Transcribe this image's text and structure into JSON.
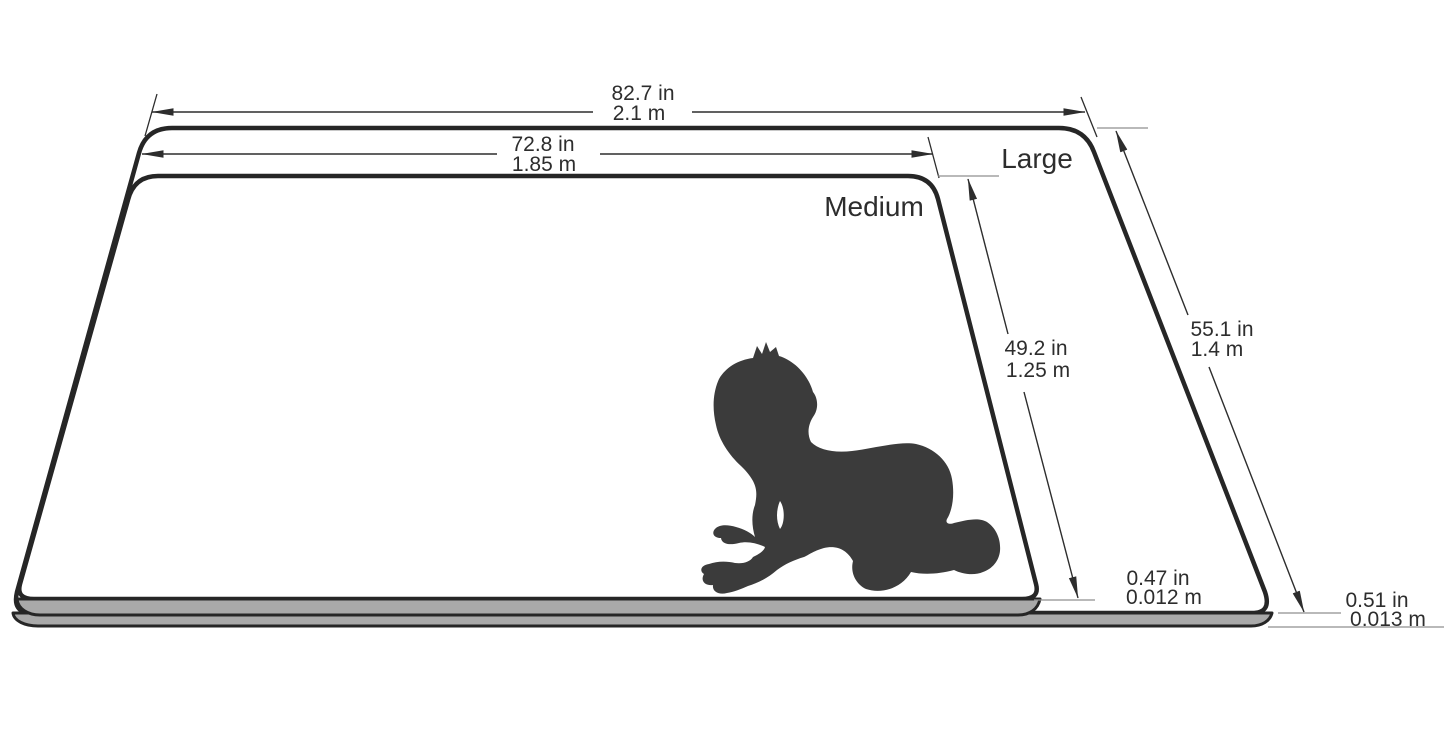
{
  "diagram": {
    "description": "Play mat size comparison diagram with crawling baby silhouette",
    "large": {
      "label": "Large",
      "width_in": "82.7 in",
      "width_m": "2.1 m",
      "depth_in": "55.1 in",
      "depth_m": "1.4 m",
      "thickness_in": "0.51 in",
      "thickness_m": "0.013 m"
    },
    "medium": {
      "label": "Medium",
      "width_in": "72.8 in",
      "width_m": "1.85 m",
      "depth_in": "49.2 in",
      "depth_m": "1.25 m",
      "thickness_in": "0.47 in",
      "thickness_m": "0.012 m"
    },
    "colors": {
      "background": "#ffffff",
      "mat_surface": "#ffffff",
      "mat_outline": "#262626",
      "mat_edge_gray": "#a9a9a9",
      "silhouette": "#3b3b3b",
      "dimension_line": "#333333",
      "extension_line": "#8f8f8f",
      "text": "#2d2d2d"
    }
  }
}
